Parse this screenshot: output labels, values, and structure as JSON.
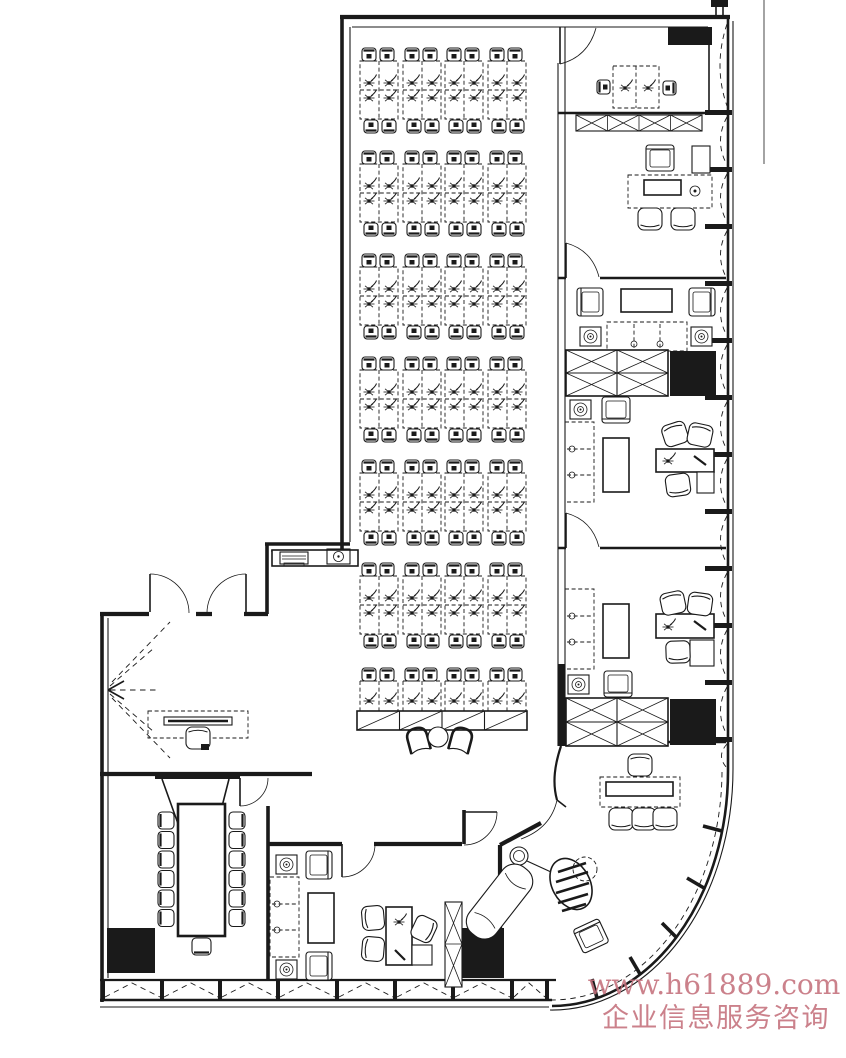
{
  "watermark": {
    "line1": "www.h61889.com",
    "line2": "企业信息服务咨询",
    "color": "#c4707c"
  },
  "drawing": {
    "ink_color": "#1a1a1a",
    "background_color": "#ffffff"
  }
}
